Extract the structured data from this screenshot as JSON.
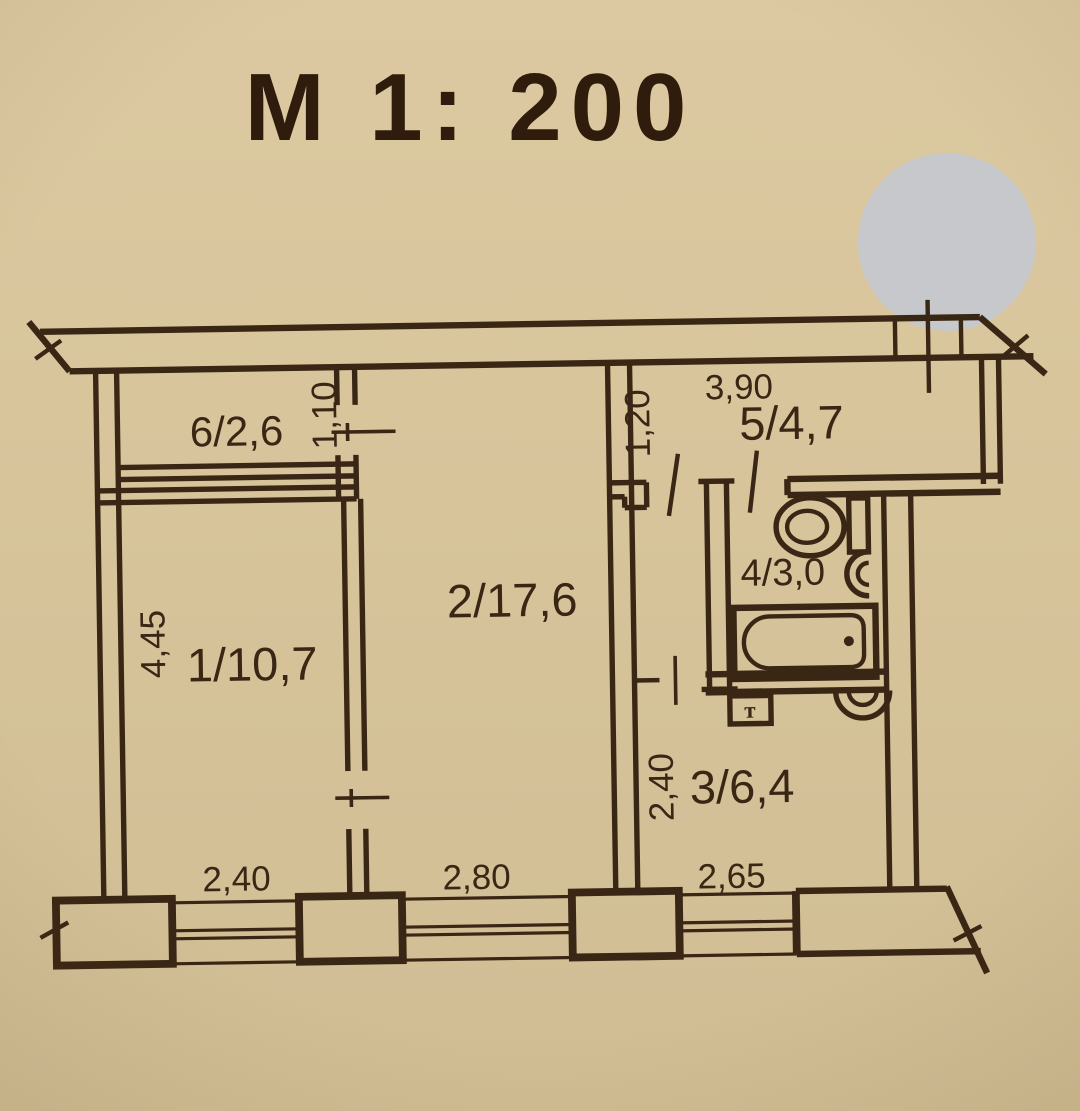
{
  "document_type": "apartment floor plan (scanned technical passport drawing)",
  "title": "М 1: 200",
  "colors": {
    "paper": "#d7c49b",
    "ink": "#3a2614",
    "title": "#2f1c0c",
    "stamp": "#c6c8cc"
  },
  "stamp": {
    "shape": "gray-circle-overlay"
  },
  "rooms": {
    "room1": {
      "label": "1/10,7"
    },
    "room2": {
      "label": "2/17,6"
    },
    "room3": {
      "label": "3/6,4"
    },
    "room4": {
      "label": "4/3,0"
    },
    "room5": {
      "label": "5/4,7"
    },
    "room6": {
      "label": "6/2,6"
    }
  },
  "dimensions": {
    "room1_height": "4,45",
    "door_room6_width": "1,10",
    "room5_depth": "1,20",
    "room5_length": "3,90",
    "room3_height": "2,40",
    "window_left": "2,40",
    "window_middle": "2,80",
    "window_right": "2,65"
  },
  "fixtures": {
    "towel_dryer_letter": "т"
  }
}
